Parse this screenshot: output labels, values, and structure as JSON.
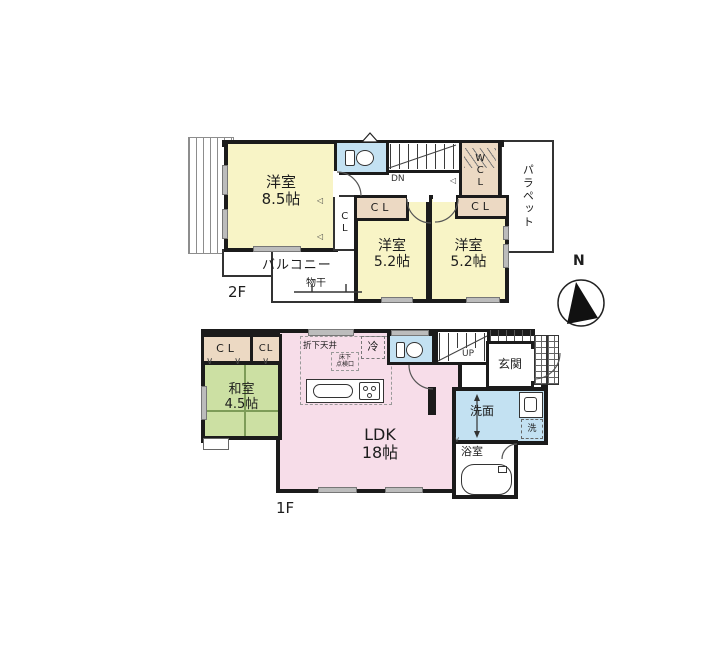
{
  "colors": {
    "room_yellow": "#f8f4c6",
    "ldk_pink": "#f7dde9",
    "tatami_green": "#cce0a3",
    "closet_tan": "#ecd9c3",
    "water_blue": "#c3e1f2",
    "wall": "#1b1b1b"
  },
  "floor2": {
    "floor_label": "2F",
    "rooms": {
      "western_85": {
        "name": "洋室",
        "size": "8.5帖"
      },
      "western_52_center": {
        "name": "洋室",
        "size": "5.2帖"
      },
      "western_52_right": {
        "name": "洋室",
        "size": "5.2帖"
      }
    },
    "closets": {
      "cl_side": "CL",
      "cl_center": "CL",
      "cl_right": "CL",
      "wcl": "WCL"
    },
    "balcony": "バルコニー",
    "laundry_pole": "物干",
    "parapet": "パラペット",
    "stairs_down": "DN"
  },
  "floor1": {
    "floor_label": "1F",
    "closets": {
      "cl_a": "CL",
      "cl_b": "CL"
    },
    "rooms": {
      "japanese": {
        "name": "和室",
        "size": "4.5帖"
      },
      "ldk": {
        "name": "LDK",
        "size": "18帖"
      },
      "entrance": "玄関",
      "washroom": "洗面",
      "bathroom": "浴室",
      "washer": "洗"
    },
    "kitchen": {
      "lowered_ceiling": "折下天井",
      "underfloor_line1": "床下",
      "underfloor_line2": "点検口",
      "fridge": "冷"
    },
    "stairs_up": "UP"
  },
  "compass": {
    "north": "N"
  },
  "icons": {
    "door_fold_marker": "◁",
    "sliding_door_mark": "∨"
  }
}
